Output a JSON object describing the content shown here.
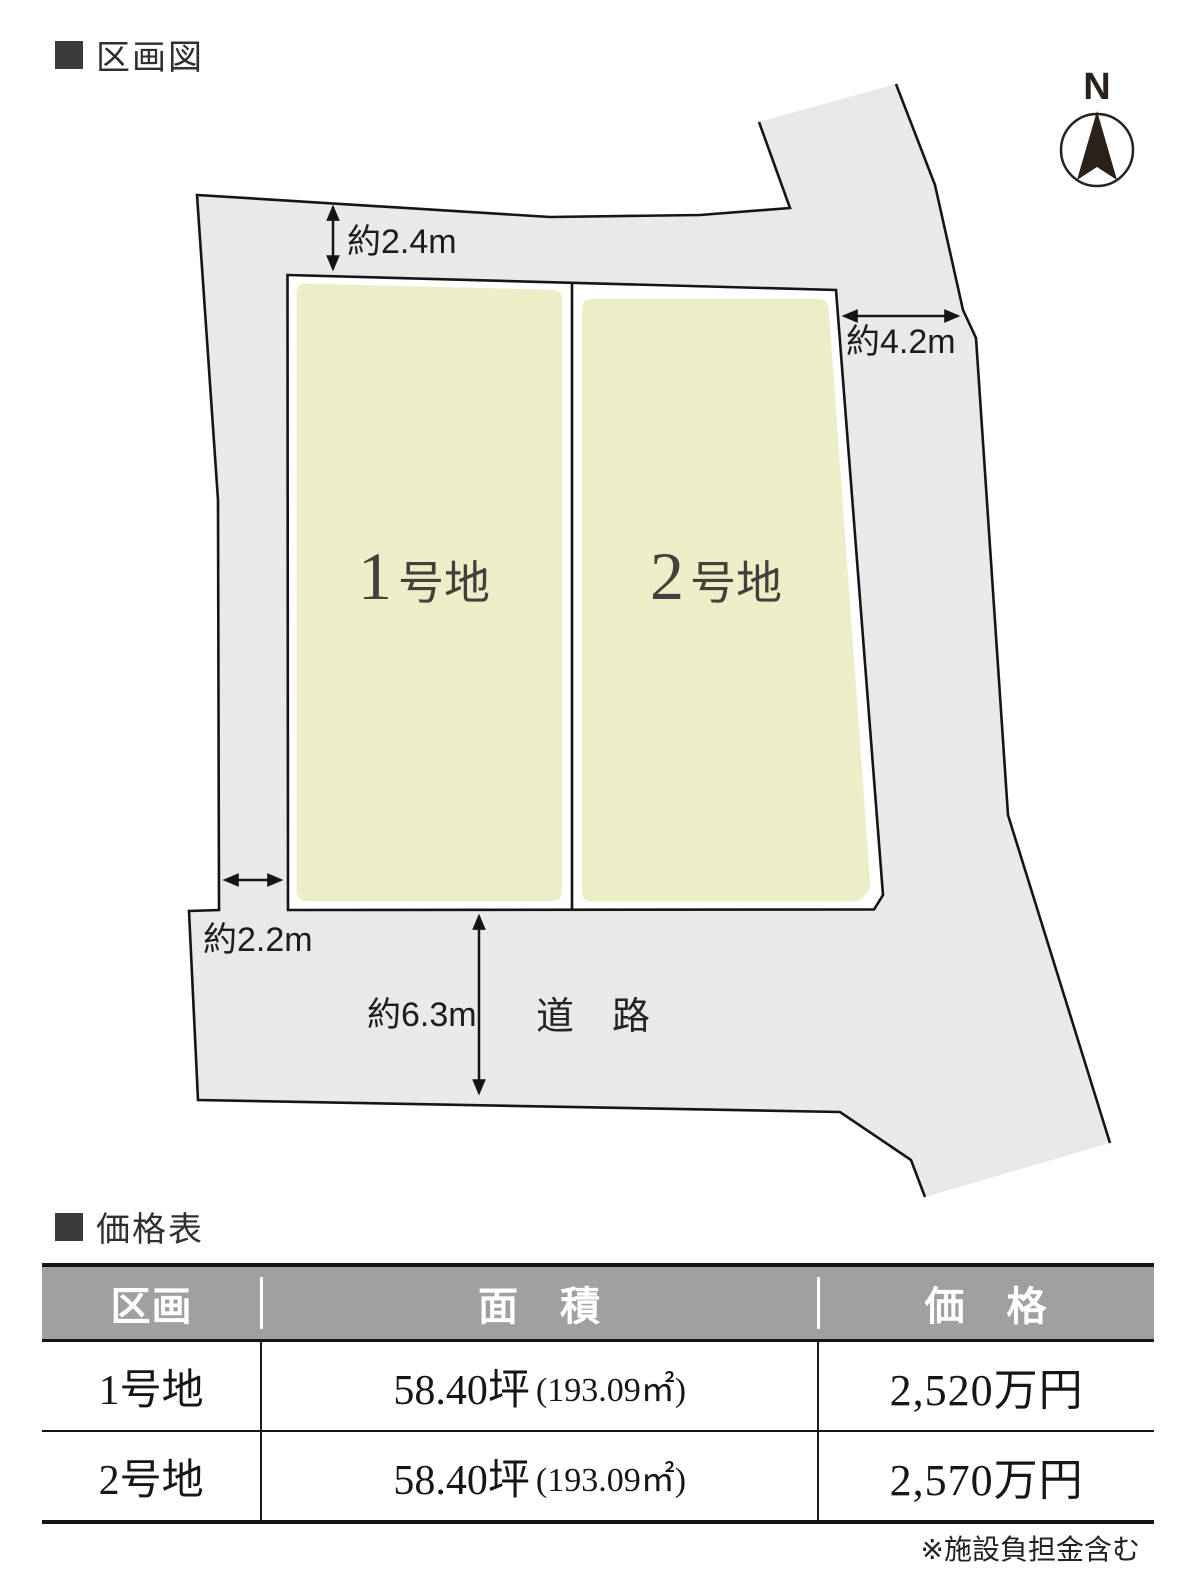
{
  "plot_map": {
    "heading": "区画図",
    "compass": {
      "label": "N"
    },
    "road_label": "道　路",
    "dimensions": {
      "top_setback": "約2.4m",
      "right_width": "約4.2m",
      "left_width": "約2.2m",
      "road_width": "約6.3m"
    },
    "plots": [
      {
        "number": "1",
        "suffix": "号地"
      },
      {
        "number": "2",
        "suffix": "号地"
      }
    ],
    "colors": {
      "land_fill": "#e9e9ea",
      "plot_fill": "#ededc7",
      "outline": "#151515",
      "plot_label": "#42413c"
    }
  },
  "price_table": {
    "heading": "価格表",
    "columns": [
      "区画",
      "面　積",
      "価　格"
    ],
    "rows": [
      {
        "name": "1号地",
        "area_main": "58.40坪",
        "area_paren": "(193.09㎡)",
        "price": "2,520万円"
      },
      {
        "name": "2号地",
        "area_main": "58.40坪",
        "area_paren": "(193.09㎡)",
        "price": "2,570万円"
      }
    ],
    "footnote": "※施設負担金含む",
    "colors": {
      "header_bg": "#a0a0a0",
      "header_text": "#ffffff"
    }
  }
}
